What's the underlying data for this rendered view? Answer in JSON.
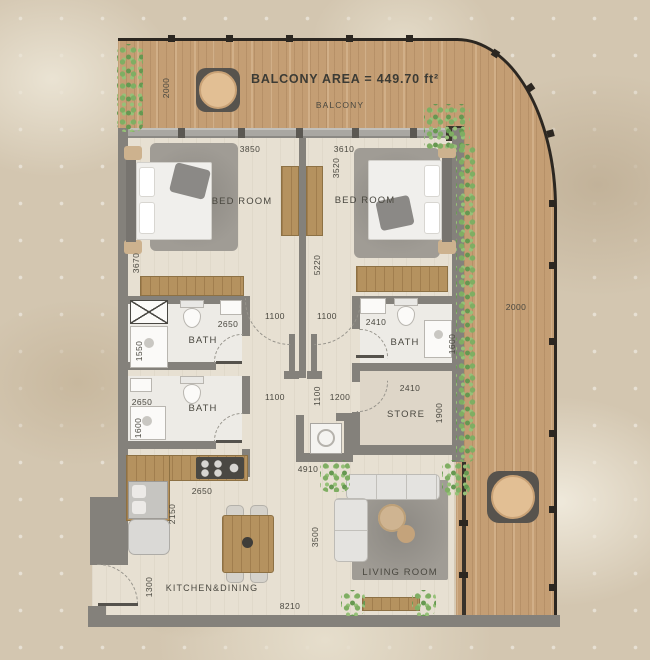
{
  "title": {
    "balcony_area_label": "BALCONY AREA = 449.70 ft²",
    "balcony_label": "BALCONY"
  },
  "rooms": {
    "bedroom1": {
      "label": "BED ROOM",
      "width": "3850",
      "depth": "3670"
    },
    "bedroom2": {
      "label": "BED ROOM",
      "width": "3610",
      "wardrobe_depth": "3520"
    },
    "hall": {
      "length": "5220",
      "top_left": "1100",
      "top_right": "1100",
      "bottom_left": "1100",
      "bottom_mid": "1100",
      "bottom_right": "1200",
      "niche_width": "4910"
    },
    "bath1": {
      "label": "BATH",
      "width": "2650",
      "depth": "1550"
    },
    "bath2": {
      "label": "BATH",
      "width": "2410",
      "depth": "1600"
    },
    "bath3": {
      "label": "BATH",
      "width": "2650",
      "depth": "1600"
    },
    "store": {
      "label": "STORE",
      "width": "2410",
      "depth": "1900"
    },
    "kitchen": {
      "label": "KITCHEN&DINING",
      "counter_width": "2650",
      "counter_depth": "2150",
      "entry_width": "1300",
      "total_width": "8210"
    },
    "living": {
      "label": "LIVING ROOM",
      "depth": "3500"
    },
    "balcony": {
      "depth": "2000"
    },
    "deck": {
      "width": "2000"
    }
  },
  "colors": {
    "deck_wood": "#c49e74",
    "wall_gray": "#84817b",
    "floor": "#e7e0d2",
    "plant_green": "#7fae63",
    "railing": "#2c2721",
    "text": "#4a4840"
  }
}
